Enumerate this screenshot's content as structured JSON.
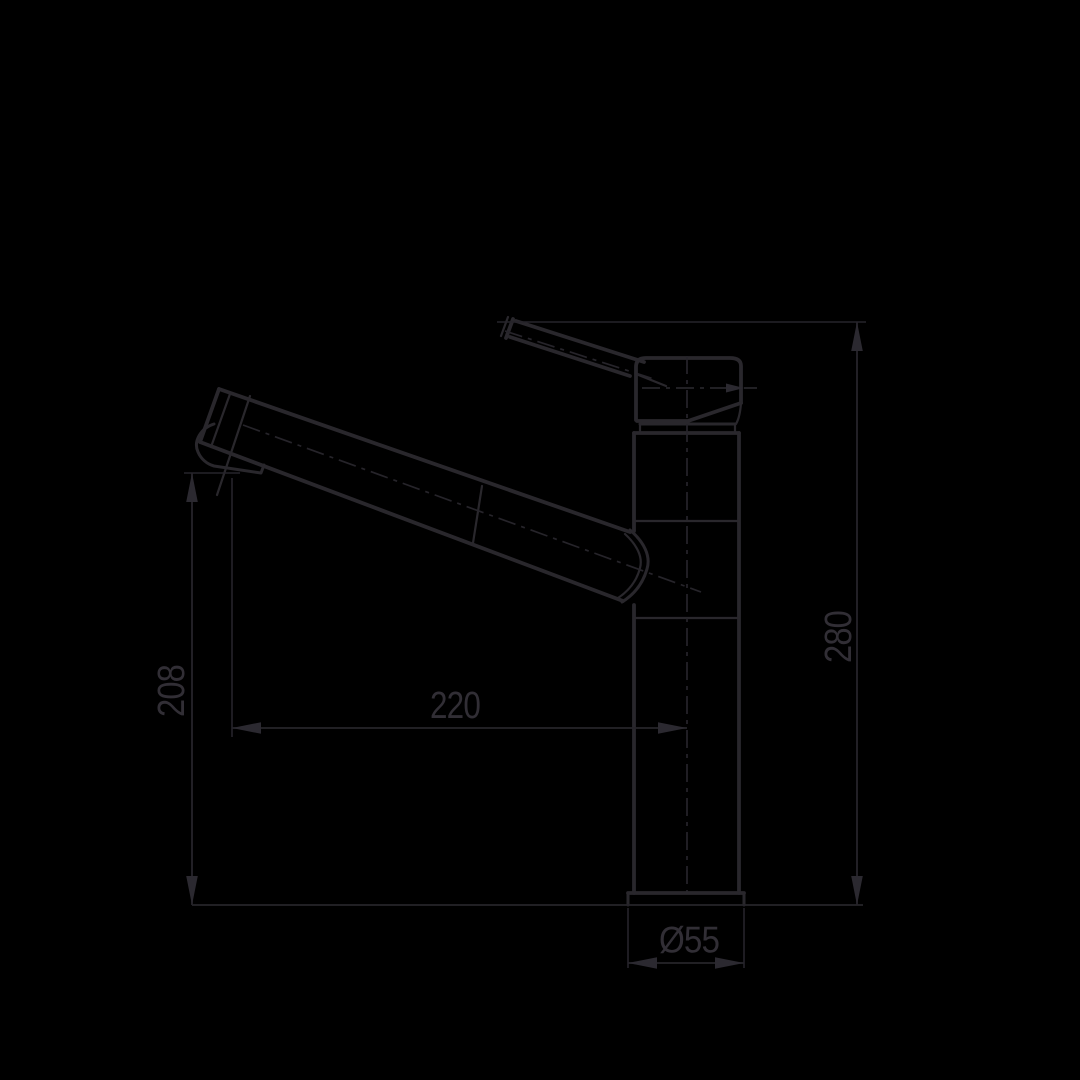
{
  "page": {
    "background_color": "#000000"
  },
  "drawing": {
    "line_color": "#29272c",
    "text_color": "#312e35",
    "labels": {
      "overall_height": "280",
      "outlet_height": "208",
      "spout_reach": "220",
      "base_diameter": "Ø55"
    }
  }
}
